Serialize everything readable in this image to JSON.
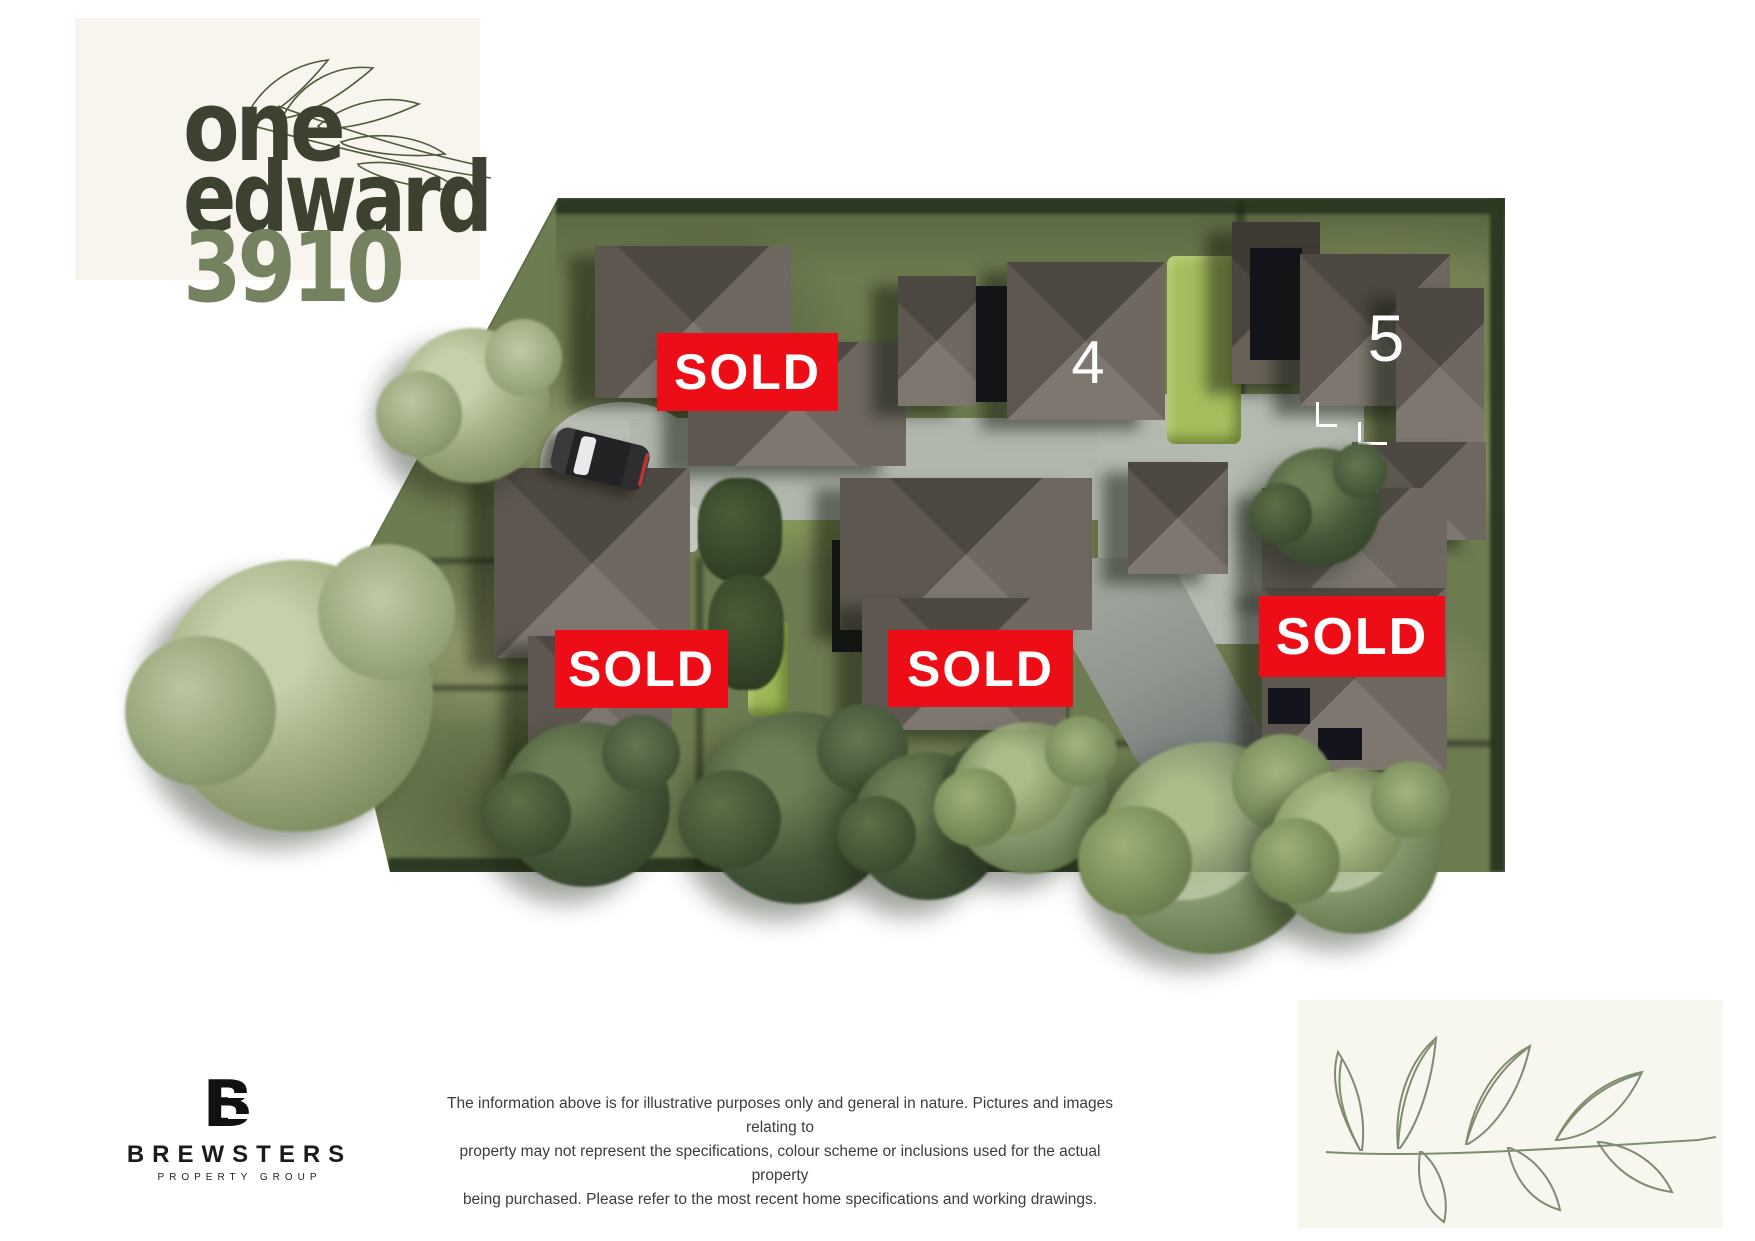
{
  "brand": {
    "word1": "one",
    "word2": "edward",
    "word3": "3910",
    "color_dark": "#3c4130",
    "color_accent": "#75825f"
  },
  "site": {
    "sold_label": "SOLD",
    "lot4_number": "4",
    "lot5_number": "5",
    "sold_count": 4,
    "colors": {
      "sold_red": "#ed0d16",
      "grass": "#6e7c51",
      "roof_light": "#7d7770",
      "roof_dark": "#4e4842",
      "driveway": "#b2b8ae",
      "hedge_bright": "#a6bf5e"
    }
  },
  "footer": {
    "logo": {
      "monogram": "B",
      "name": "BREWSTERS",
      "tagline": "PROPERTY GROUP"
    },
    "disclaimer": {
      "line1": "The information above is for illustrative purposes only and general in nature. Pictures and images relating to",
      "line2": "property may not represent the specifications, colour scheme or inclusions used for the actual property",
      "line3": "being purchased. Please refer to the most recent home specifications and working drawings."
    }
  }
}
